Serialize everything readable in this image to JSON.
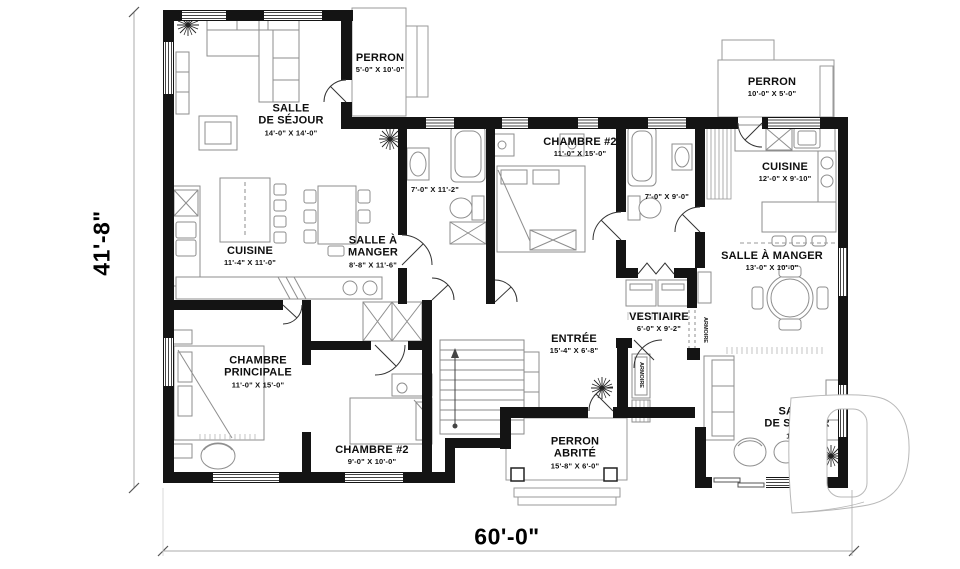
{
  "overall_dimensions": {
    "height": "41'-8\"",
    "width": "60'-0\""
  },
  "rooms": [
    {
      "id": "sejour-left",
      "name": "SALLE\nDE SÉJOUR",
      "dims": "14'-0\" X 14'-0\""
    },
    {
      "id": "perron-top",
      "name": "PERRON",
      "dims": "5'-0\" X 10'-0\""
    },
    {
      "id": "chambre2-top",
      "name": "CHAMBRE #2",
      "dims": "11'-0\" X 15'-0\""
    },
    {
      "id": "salle-de-bain-gauche",
      "name": "",
      "dims": "7'-0\" X 11'-2\""
    },
    {
      "id": "salle-de-bain-droite",
      "name": "",
      "dims": "7'-0\" X 9'-0\""
    },
    {
      "id": "perron-right",
      "name": "PERRON",
      "dims": "10'-0\" X 5'-0\""
    },
    {
      "id": "cuisine-right",
      "name": "CUISINE",
      "dims": "12'-0\" X 9'-10\""
    },
    {
      "id": "cuisine-left",
      "name": "CUISINE",
      "dims": "11'-4\" X 11'-0\""
    },
    {
      "id": "salle-a-manger-left",
      "name": "SALLE À\nMANGER",
      "dims": "8'-8\" X 11'-6\""
    },
    {
      "id": "salle-a-manger-right",
      "name": "SALLE À MANGER",
      "dims": "13'-0\" X 10'-0\""
    },
    {
      "id": "vestiaire",
      "name": "VESTIAIRE",
      "dims": "6'-0\" X 9'-2\""
    },
    {
      "id": "entree",
      "name": "ENTRÉE",
      "dims": "15'-4\" X 6'-8\""
    },
    {
      "id": "chambre-principale",
      "name": "CHAMBRE\nPRINCIPALE",
      "dims": "11'-0\" X 15'-0\""
    },
    {
      "id": "chambre2-bottom",
      "name": "CHAMBRE #2",
      "dims": "9'-0\" X 10'-0\""
    },
    {
      "id": "perron-abrite",
      "name": "PERRON\nABRITÉ",
      "dims": "15'-8\" X 6'-0\""
    },
    {
      "id": "sejour-right",
      "name": "SALLE\nDE SÉJOUR",
      "dims": "10'-6\""
    }
  ],
  "annotations": {
    "closet_entry": "ARMOIRE",
    "closet_hall": "ARMOIRE"
  },
  "watermark": {
    "letter": "D"
  },
  "colors": {
    "wall": "#141414",
    "furniture_line": "#8e8e8e",
    "background": "#ffffff"
  }
}
